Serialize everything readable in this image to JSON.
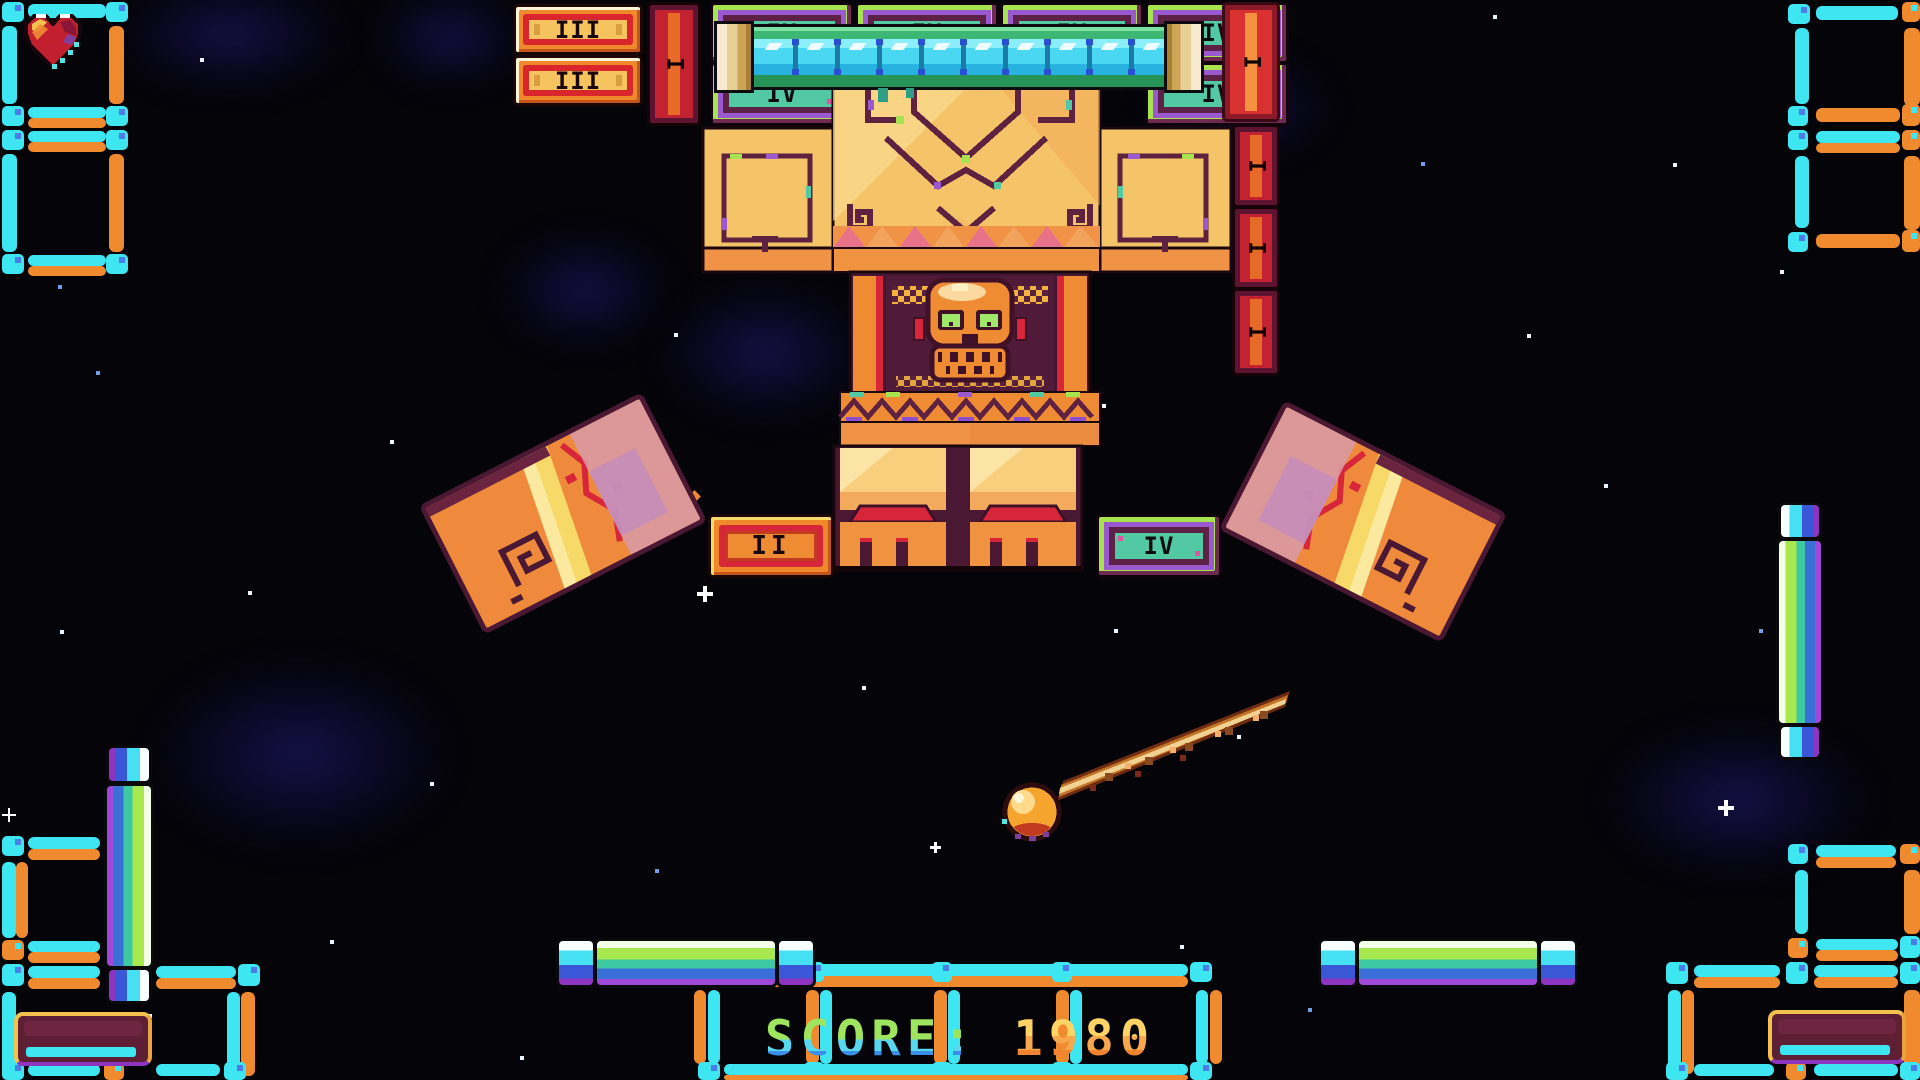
{
  "game": {
    "score": {
      "label": "SCORE:",
      "value": "1980"
    },
    "lives": {
      "icon": "heart-icon",
      "hearts_visible": 1
    },
    "brick_labels": {
      "i": "I",
      "ii": "II",
      "iii": "III",
      "iv": "IV"
    },
    "icons": {
      "life": "heart-icon",
      "ball": "fireball",
      "idol": "skull-icon"
    },
    "colors": {
      "background": "#050409",
      "frame_cyan": "#3ee6f2",
      "frame_orange": "#f08a2e",
      "brick_orange": "#f0882c",
      "brick_red": "#d9252c",
      "brick_gold_panel": "#f5c45e",
      "brick_lime": "#a6e34e",
      "brick_purple": "#9b59d0",
      "brick_teal": "#53c9a3",
      "temple_gold": "#f6c468",
      "temple_maroon": "#5e2240",
      "temple_orange": "#ef8c33",
      "skull_eye_green": "#9fe86a",
      "tube_glass": "#49d7f2",
      "tube_green": "#2ea05e",
      "gold_cap": "#e8cf96",
      "pill_stripes": [
        "#f4ffe8",
        "#a6e84e",
        "#3cc9a3",
        "#3a6fd8",
        "#a049d8"
      ],
      "score_green": "#9fe45e",
      "score_gold": "#ffd465",
      "ball": "#f5a52e",
      "trail": "#c27427",
      "heart_red": "#c3202f"
    }
  }
}
